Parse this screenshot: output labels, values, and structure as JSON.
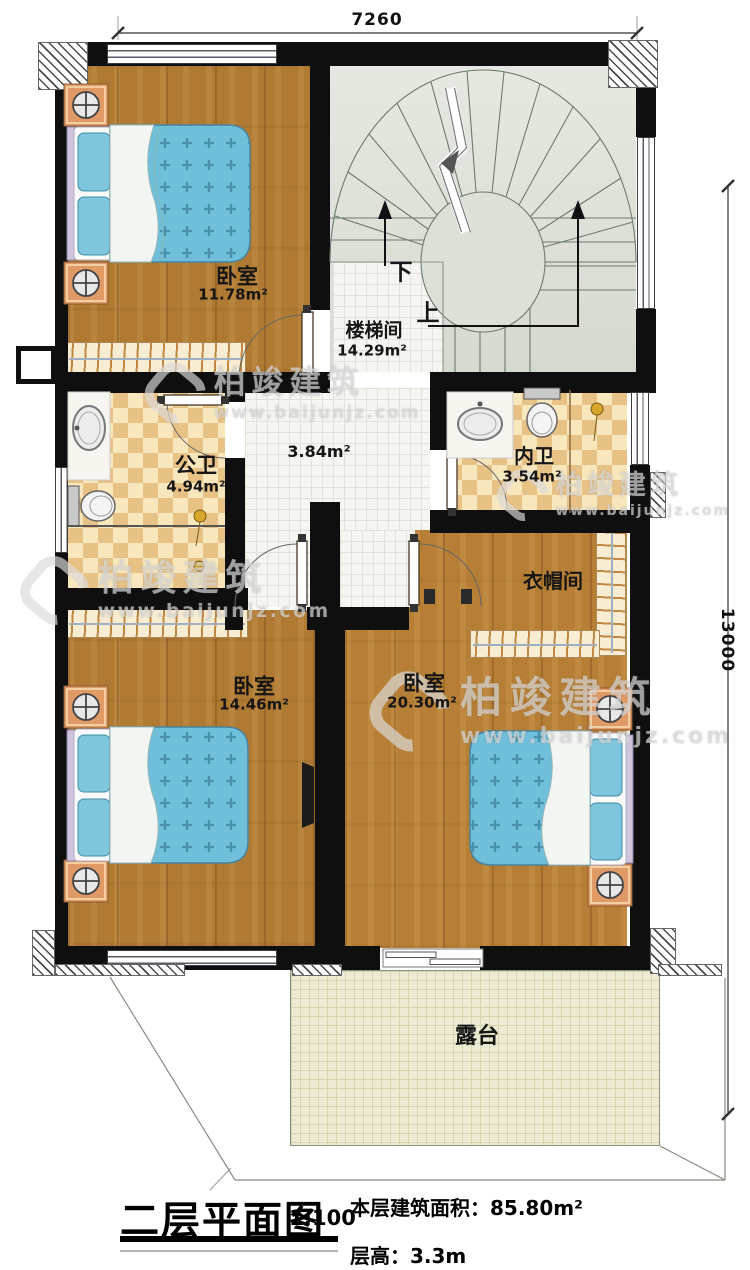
{
  "dimensions": {
    "width_mm": "7260",
    "height_mm": "13000"
  },
  "rooms": {
    "bedroom_tl": {
      "name": "卧室",
      "area": "11.78m²"
    },
    "stairwell": {
      "name": "楼梯间",
      "area": "14.29m²",
      "down": "下",
      "up": "上"
    },
    "hallway": {
      "area": "3.84m²"
    },
    "public_bath": {
      "name": "公卫",
      "area": "4.94m²"
    },
    "ensuite_bath": {
      "name": "内卫",
      "area": "3.54m²"
    },
    "cloakroom": {
      "name": "衣帽间"
    },
    "bedroom_bl": {
      "name": "卧室",
      "area": "14.46m²"
    },
    "bedroom_br": {
      "name": "卧室",
      "area": "20.30m²"
    },
    "terrace": {
      "name": "露台"
    }
  },
  "title_block": {
    "title": "二层平面图",
    "scale": "1:100",
    "floor_area_label": "本层建筑面积：",
    "floor_area_value": "85.80m²",
    "floor_height_label": "层高：",
    "floor_height_value": "3.3m"
  },
  "watermark": {
    "brand": "柏竣建筑",
    "url": "www.baijunjz.com"
  },
  "colors": {
    "wall": "#0f0f0f",
    "wood": "#b07a33",
    "tile_checker": "#e8c185",
    "bed": "#6fbeda",
    "accent_gold": "#d8a62a"
  }
}
